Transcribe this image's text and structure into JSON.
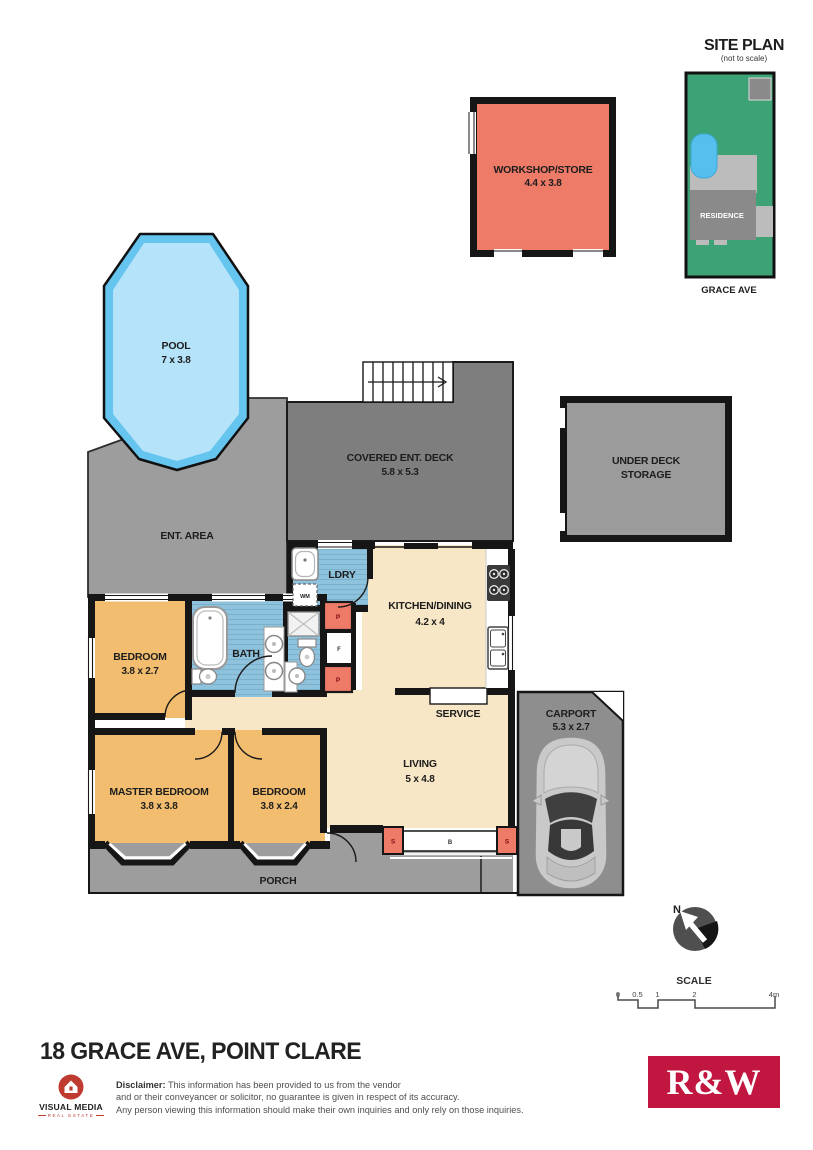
{
  "colors": {
    "wall": "#161616",
    "salmon": "#EE7A68",
    "orange": "#F2BD6E",
    "cream": "#F8E7C6",
    "tileBlue": "#8FC2DC",
    "tileLine": "#7BB0CB",
    "poolRim": "#66C5EF",
    "poolWater": "#B5E3F9",
    "deckGray": "#7E7E7E",
    "pavingGray": "#9D9D9D",
    "carportGray": "#8E8E8E",
    "storageGray": "#9B9B9B",
    "siteGreen": "#3EA277",
    "siteGray": "#8A8A8A",
    "siteLight": "#BCBCBC",
    "sitePool": "#56BFEE",
    "rwRed": "#C11640",
    "vmRed": "#BF3B30"
  },
  "site_plan": {
    "title": "SITE PLAN",
    "subtitle": "(not to scale)",
    "residence": "RESIDENCE",
    "street": "GRACE AVE"
  },
  "plan": {
    "workshop_name": "WORKSHOP/STORE",
    "workshop_dims": "4.4 x 3.8",
    "pool_name": "POOL",
    "pool_dims": "7 x 3.8",
    "deck_name": "COVERED ENT. DECK",
    "deck_dims": "5.8 x 5.3",
    "storage_line1": "UNDER DECK",
    "storage_line2": "STORAGE",
    "ent_area": "ENT. AREA",
    "laundry": "LDRY",
    "kitchen_name": "KITCHEN/DINING",
    "kitchen_dims": "4.2 x 4",
    "bath": "BATH",
    "bedroom1_name": "BEDROOM",
    "bedroom1_dims": "3.8 x 2.7",
    "service": "SERVICE",
    "living_name": "LIVING",
    "living_dims": "5 x 4.8",
    "master_name": "MASTER BEDROOM",
    "master_dims": "3.8 x 3.8",
    "bedroom2_name": "BEDROOM",
    "bedroom2_dims": "3.8 x 2.4",
    "carport_name": "CARPORT",
    "carport_dims": "5.3 x 2.7",
    "porch": "PORCH",
    "wm": "WM",
    "pantry": "P",
    "fridge": "F",
    "post": "S",
    "bifold": "B"
  },
  "compass": {
    "north": "N"
  },
  "scale_bar": {
    "title": "SCALE",
    "ticks": [
      "0",
      "0.5",
      "1",
      "2",
      "4m"
    ]
  },
  "footer": {
    "address": "18 GRACE AVE, POINT CLARE",
    "vm_name": "VISUAL MEDIA",
    "vm_sub": "REAL ESTATE",
    "disclaimer_label": "Disclaimer:",
    "disclaimer_line1": "This information has been provided to us from the vendor",
    "disclaimer_line2": "and or their conveyancer or solicitor, no guarantee is given in respect of its accuracy.",
    "disclaimer_line3": "Any person viewing this information should make their own inquiries and only rely on those inquiries.",
    "rw": "R&W"
  }
}
